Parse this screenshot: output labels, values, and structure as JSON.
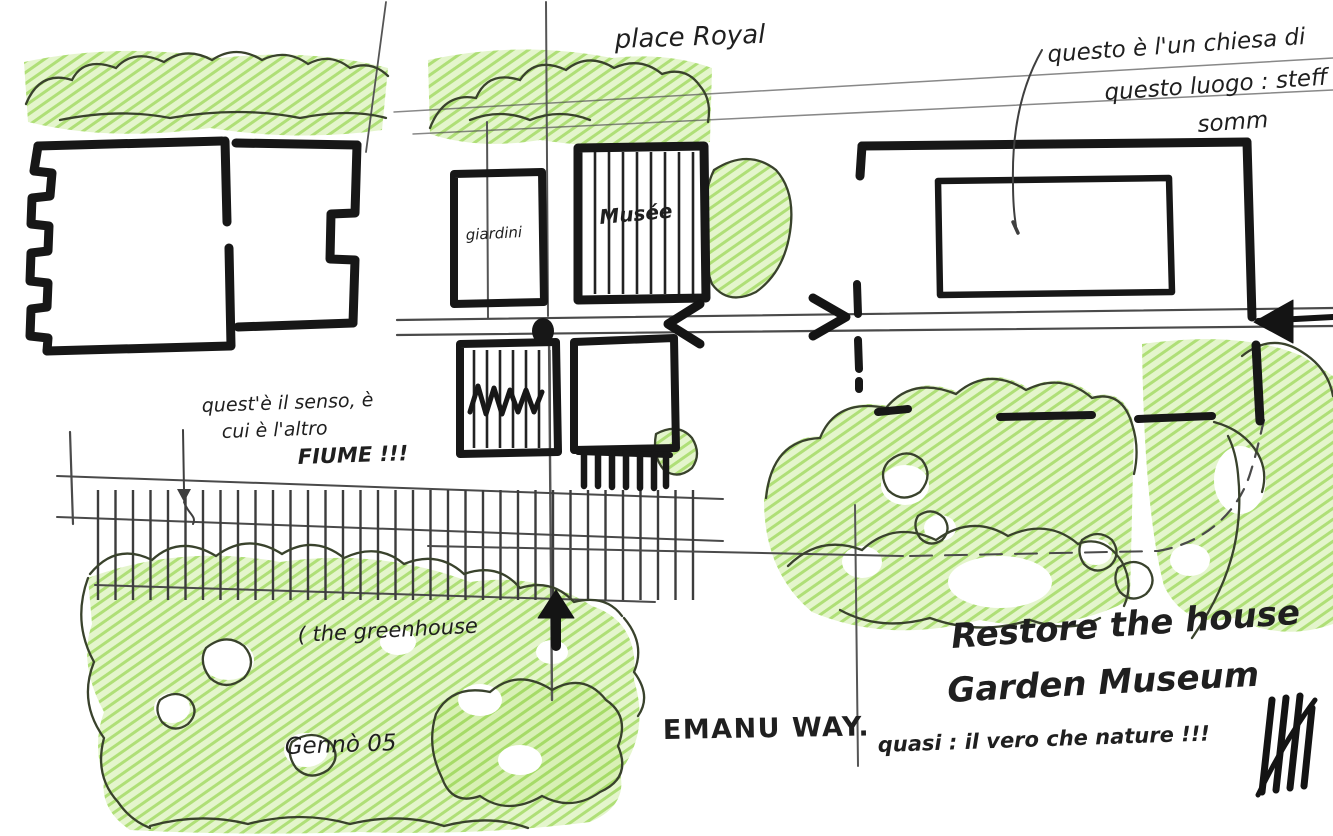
{
  "sketch": {
    "type": "architectural-site-plan-sketch",
    "labels": {
      "place": "place Royal",
      "top_right_note_1": "questo è l'un chiesa di",
      "top_right_note_2": "questo luogo : steff",
      "top_right_note_3": "somm",
      "left_note_1": "quest'è il senso, è",
      "left_note_2": "cui è l'altro",
      "left_note_3": "FIUME !!!",
      "small_square": "giardini",
      "hatched_square": "Musée",
      "greenhouse": "( the greenhouse",
      "date": "Gennò 05",
      "way": "EMANU WAY.",
      "big_note_1": "Restore the house",
      "big_note_2": "Garden Museum",
      "bottom_right_note": "quasi : il vero che nature !!!"
    },
    "colors": {
      "ink": "#171717",
      "pencil": "#555555",
      "crayon_green": "#a9dd60",
      "crayon_green_light": "#cdeca2",
      "tree_outline": "#39422c",
      "paper": "#ffffff"
    }
  }
}
